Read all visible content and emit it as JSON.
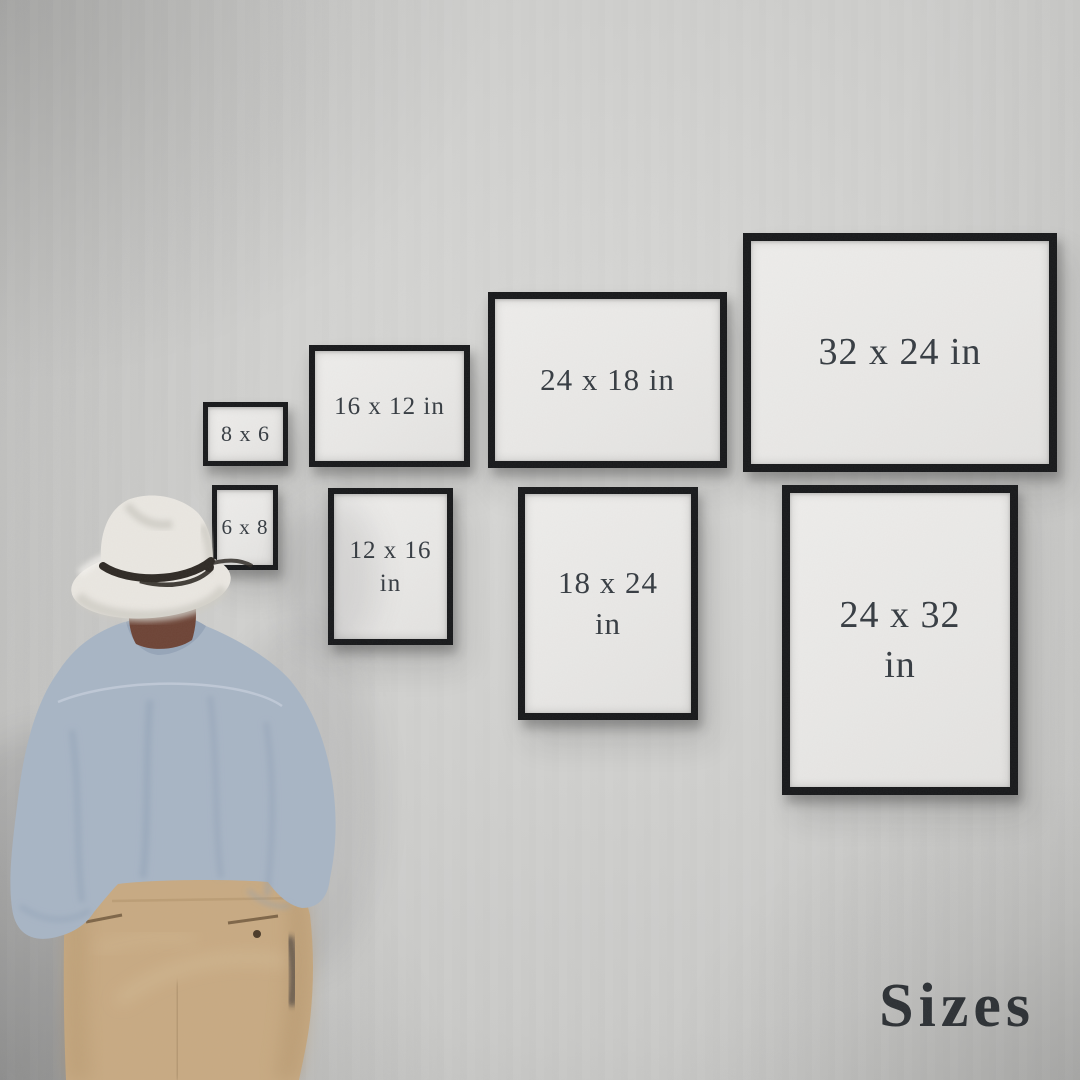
{
  "scene": {
    "kind": "framed-print-size-guide-photo",
    "title": "Sizes"
  },
  "wall": {
    "base": "#cbcbc9",
    "light": "#d9d9d7",
    "dark": "#a7a7a5"
  },
  "frame_style": {
    "border_color": "#17181a",
    "face_color": "#eae9e7"
  },
  "text_colors": {
    "frame_label": "#353b41",
    "title": "#2c3034"
  },
  "figure": {
    "hat": "#eae7e1",
    "hat_shade": "#cfccc5",
    "hat_highlight": "#f4f2ee",
    "hat_band": "#2e2924",
    "hair": "#6d4335",
    "shirt": "#a8b5c5",
    "shirt_shade": "#8da0b4",
    "shirt_seam": "#c3cdd9",
    "collar": "#96a5b8",
    "pants": "#c8aa82",
    "pants_shade": "#b3946c",
    "pants_crease": "#8a6f4e",
    "pants_highlight": "#dcc6a3",
    "pocket": "#7e6547",
    "button": "#4a3a28",
    "shadow": "#20242a"
  },
  "frames": [
    {
      "id": "8x6",
      "lines": [
        "8 x 6"
      ],
      "orientation": "landscape",
      "x": 203,
      "y": 402,
      "w": 85,
      "h": 64,
      "border": 5,
      "font": 22
    },
    {
      "id": "16x12",
      "lines": [
        "16 x 12 in"
      ],
      "orientation": "landscape",
      "x": 309,
      "y": 345,
      "w": 161,
      "h": 122,
      "border": 6,
      "font": 25
    },
    {
      "id": "24x18",
      "lines": [
        "24 x 18 in"
      ],
      "orientation": "landscape",
      "x": 488,
      "y": 292,
      "w": 239,
      "h": 176,
      "border": 7,
      "font": 31
    },
    {
      "id": "32x24",
      "lines": [
        "32 x 24 in"
      ],
      "orientation": "landscape",
      "x": 743,
      "y": 233,
      "w": 314,
      "h": 239,
      "border": 8,
      "font": 38
    },
    {
      "id": "6x8",
      "lines": [
        "6 x 8"
      ],
      "orientation": "portrait",
      "x": 212,
      "y": 485,
      "w": 66,
      "h": 85,
      "border": 5,
      "font": 21
    },
    {
      "id": "12x16",
      "lines": [
        "12 x 16",
        "in"
      ],
      "orientation": "portrait",
      "x": 328,
      "y": 488,
      "w": 125,
      "h": 157,
      "border": 6,
      "font": 25
    },
    {
      "id": "18x24",
      "lines": [
        "18 x 24",
        "in"
      ],
      "orientation": "portrait",
      "x": 518,
      "y": 487,
      "w": 180,
      "h": 233,
      "border": 7,
      "font": 31
    },
    {
      "id": "24x32",
      "lines": [
        "24 x 32",
        "in"
      ],
      "orientation": "portrait",
      "x": 782,
      "y": 485,
      "w": 236,
      "h": 310,
      "border": 8,
      "font": 38
    }
  ]
}
